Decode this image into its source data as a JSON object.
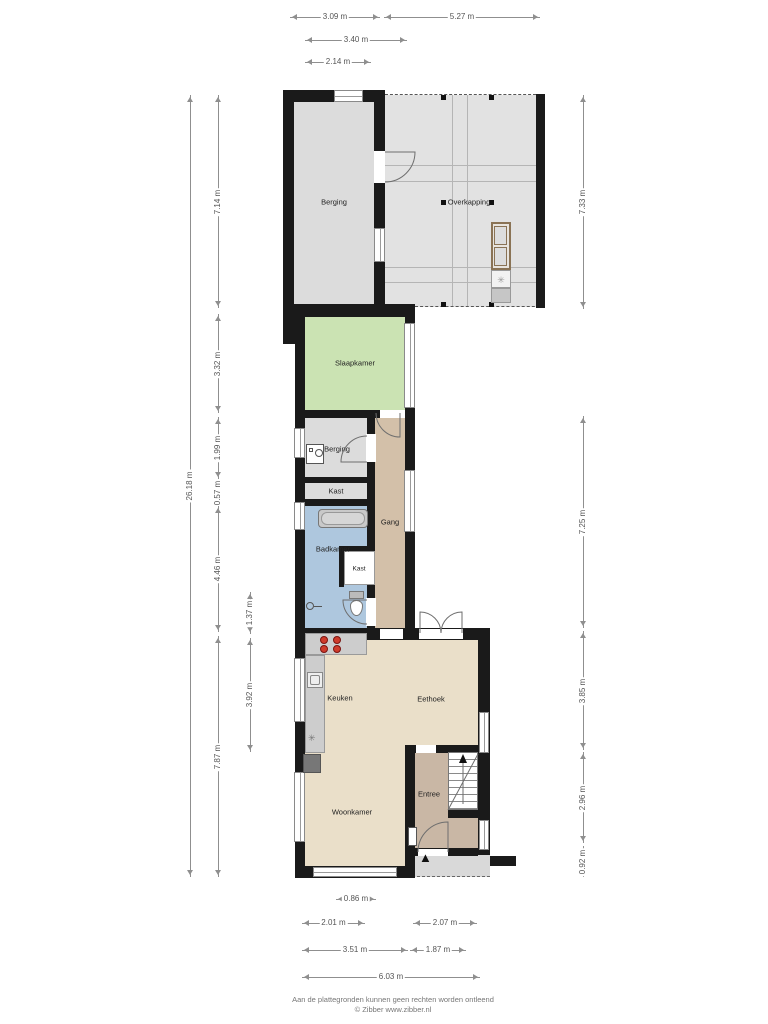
{
  "page": {
    "footer_line1": "Aan de plattegronden kunnen geen rechten worden ontleend",
    "footer_line2": "© Zibber www.zibber.nl"
  },
  "rooms": {
    "berging_top": "Berging",
    "overkapping": "Overkapping",
    "slaapkamer": "Slaapkamer",
    "berging_small": "Berging",
    "kast_upper": "Kast",
    "badkamer": "Badkamer",
    "kast_lower": "Kast",
    "gang": "Gang",
    "keuken": "Keuken",
    "eethoek": "Eethoek",
    "woonkamer": "Woonkamer",
    "entree": "Entree"
  },
  "icons": {
    "hob_star": "✳",
    "entrance_marker": "▲"
  },
  "measurements": {
    "top": [
      "3.09 m",
      "5.27 m",
      "3.40 m",
      "2.14 m"
    ],
    "left": [
      "26.18 m",
      "7.14 m",
      "3.32 m",
      "1.99 m",
      "0.57 m",
      "4.46 m",
      "7.87 m",
      "1.37 m",
      "3.92 m"
    ],
    "right": [
      "7.33 m",
      "7.25 m",
      "3.85 m",
      "2.96 m",
      "0.92 m"
    ],
    "bottom": [
      "0.86 m",
      "2.01 m",
      "2.07 m",
      "3.51 m",
      "1.87 m",
      "6.03 m"
    ]
  },
  "colors": {
    "wall": "#1a1a1a",
    "storage": "#dcdcdc",
    "canopy": "#e2e2e2",
    "bedroom": "#cbe3b3",
    "bathroom": "#aec7de",
    "hall": "#d3c0a9",
    "entry": "#c9b7a5",
    "living": "#eadfc9",
    "counter": "#cdcdcd",
    "burner": "#cf3b2b"
  }
}
